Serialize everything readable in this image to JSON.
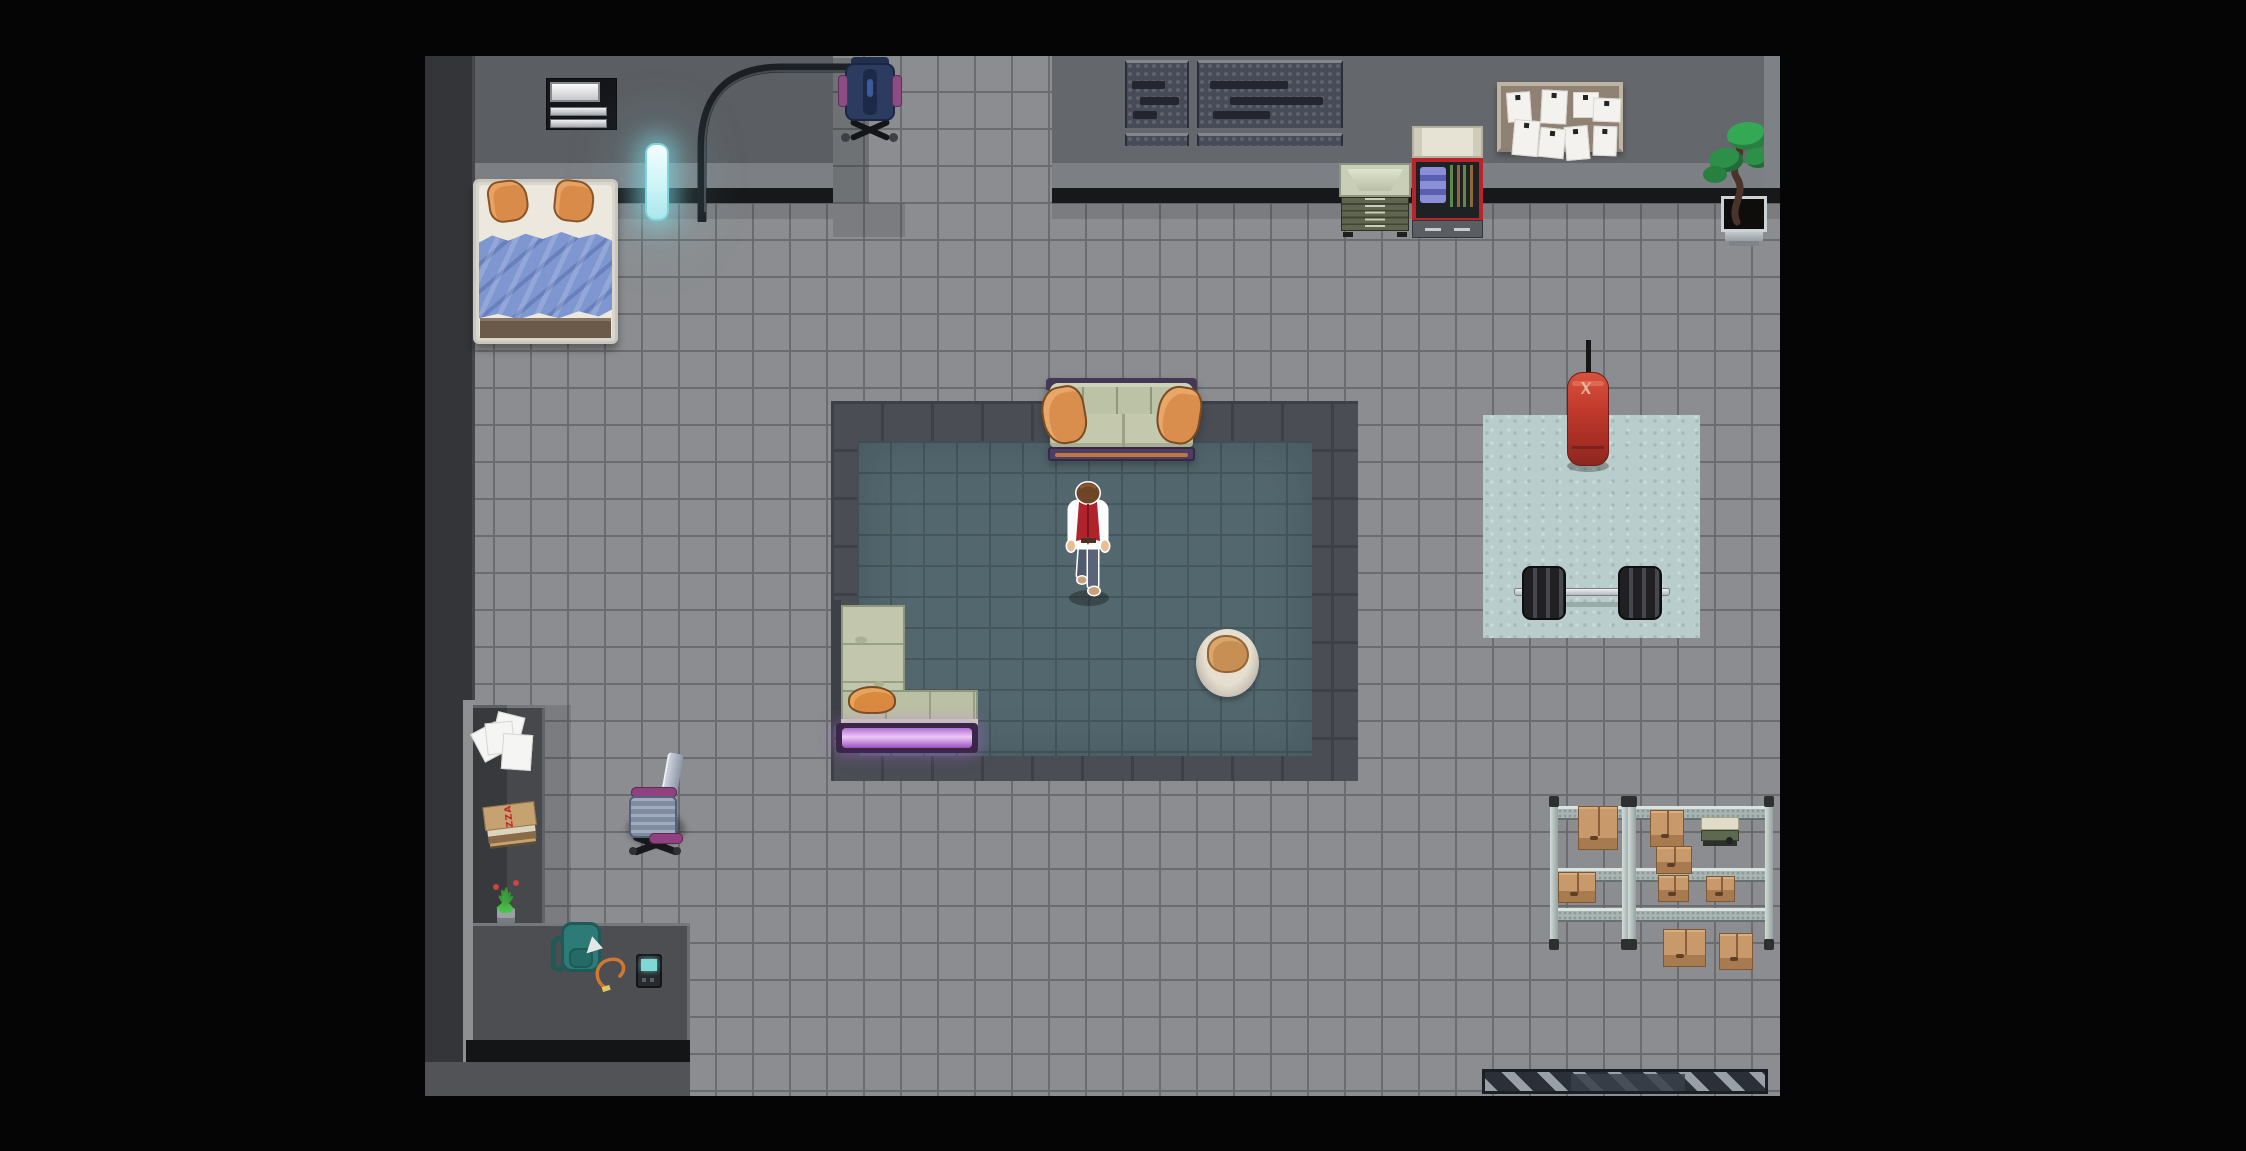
{
  "meta": {
    "scene": "top-down pixel-art apartment / loft interior",
    "viewport": {
      "width": 2246,
      "height": 1151
    },
    "map": {
      "x": 425,
      "y": 56,
      "width": 1355,
      "height": 1040
    }
  },
  "labels": {
    "pizza_box_text": "PIZZA"
  },
  "palette": {
    "letterbox": "#050505",
    "floor_tile": "#8b8d90",
    "floor_grout": "#6a6c6f",
    "wall_left": "#5b5e62",
    "wall_right": "#64676b",
    "wall_band": "#7c7f84",
    "wall_base": "#17181a",
    "border_zone": "#4a4d54",
    "rug_teal": "#53676e",
    "gym_mat": "#b9cecc",
    "dark_zone": "#46484c",
    "hazard_light": "#99a0a8",
    "hazard_dark": "#2a2f38",
    "sofa_green": "#c2c6ad",
    "pillow_orange": "#d98c4a",
    "sofa_base_purple": "#4e3e65",
    "glow_purple": "#ecc9f7",
    "bed_blanket_blue": "#7e97d0",
    "punching_bag_red": "#c23a2c",
    "tube_cyan": "#cdf4f6",
    "box_cardboard": "#c89a6b",
    "rack_metal": "#a9b5b2",
    "player_vest": "#b0222c",
    "player_shirt": "#fcfcfc",
    "player_pants": "#59647a",
    "player_hair": "#6f4527"
  },
  "entities": [
    {
      "name": "letterbox-left",
      "type": "letterbox",
      "x": 0,
      "y": 0,
      "w": 425,
      "h": 1151
    },
    {
      "name": "letterbox-right",
      "type": "letterbox",
      "x": 1780,
      "y": 0,
      "w": 466,
      "h": 1151
    },
    {
      "name": "letterbox-top",
      "type": "letterbox",
      "x": 425,
      "y": 0,
      "w": 1355,
      "h": 56
    },
    {
      "name": "letterbox-bottom",
      "type": "letterbox",
      "x": 425,
      "y": 1096,
      "w": 1355,
      "h": 55
    },
    {
      "name": "floor-tiles",
      "type": "floor",
      "x": 425,
      "y": 56,
      "w": 1355,
      "h": 1040
    },
    {
      "name": "left-wall-column",
      "type": "leftcol",
      "x": 425,
      "y": 56,
      "w": 50,
      "h": 1040
    },
    {
      "name": "left-edge-strip",
      "type": "lightstrip",
      "x": 463,
      "y": 700,
      "w": 12,
      "h": 362
    },
    {
      "name": "top-wall-left",
      "type": "wallL",
      "x": 475,
      "y": 56,
      "w": 358,
      "h": 147
    },
    {
      "name": "top-wall-right",
      "type": "wallR",
      "x": 1052,
      "y": 56,
      "w": 728,
      "h": 147
    },
    {
      "name": "right-wall-strip",
      "type": "wallstrip",
      "x": 1764,
      "y": 56,
      "w": 16,
      "h": 132
    },
    {
      "name": "corridor-shadow",
      "type": "shade22",
      "x": 833,
      "y": 58,
      "w": 36,
      "h": 145
    },
    {
      "name": "corridor-shadow-foot",
      "type": "shade12",
      "x": 833,
      "y": 203,
      "w": 72,
      "h": 34
    },
    {
      "name": "wall-shadow-left",
      "type": "shade12",
      "x": 475,
      "y": 203,
      "w": 358,
      "h": 16
    },
    {
      "name": "wall-shadow-right",
      "type": "shade12",
      "x": 1052,
      "y": 203,
      "w": 728,
      "h": 16
    },
    {
      "name": "sunken-border-zone",
      "type": "borderzone",
      "x": 831,
      "y": 401,
      "w": 527,
      "h": 380
    },
    {
      "name": "teal-rug",
      "type": "rug",
      "x": 857,
      "y": 441,
      "w": 455,
      "h": 315
    },
    {
      "name": "gym-mat",
      "type": "mat",
      "x": 1483,
      "y": 415,
      "w": 217,
      "h": 223
    },
    {
      "name": "storage-nook-column",
      "type": "darkzone",
      "x": 473,
      "y": 705,
      "w": 72,
      "h": 218
    },
    {
      "name": "storage-nook-platform",
      "type": "darkzone2",
      "x": 473,
      "y": 923,
      "w": 217,
      "h": 118
    },
    {
      "name": "storage-nook-shadow",
      "type": "shade12",
      "x": 545,
      "y": 705,
      "w": 26,
      "h": 218
    },
    {
      "name": "dark-desk-strip",
      "type": "darkdesk",
      "x": 466,
      "y": 1040,
      "w": 224,
      "h": 24
    },
    {
      "name": "bottom-wall-strip",
      "type": "bottomwall",
      "x": 425,
      "y": 1062,
      "w": 265,
      "h": 34
    },
    {
      "name": "hazard-strip",
      "type": "hazard",
      "x": 1482,
      "y": 1069,
      "w": 286,
      "h": 25
    },
    {
      "name": "hazard-strip-inset",
      "type": "hazardinner",
      "x": 1571,
      "y": 1074,
      "w": 114,
      "h": 17
    },
    {
      "name": "wall-shelf-unit",
      "type": "shelfunit",
      "x": 546,
      "y": 78,
      "w": 71,
      "h": 52
    },
    {
      "name": "floor-lamp",
      "type": "lamp",
      "x": 676,
      "y": 52,
      "w": 216,
      "h": 170
    },
    {
      "name": "neon-light-tube",
      "type": "tube",
      "x": 645,
      "y": 143,
      "w": 24,
      "h": 78
    },
    {
      "name": "gaming-chair",
      "type": "gamingchair",
      "x": 841,
      "y": 57,
      "w": 58,
      "h": 86
    },
    {
      "name": "acoustic-panel-left",
      "type": "acoustic",
      "x": 1125,
      "y": 60,
      "w": 64,
      "h": 68
    },
    {
      "name": "acoustic-panel-right",
      "type": "acoustic",
      "x": 1197,
      "y": 60,
      "w": 146,
      "h": 68
    },
    {
      "name": "acoustic-panel-left-lower",
      "type": "acoustic2",
      "x": 1125,
      "y": 133,
      "w": 64,
      "h": 13
    },
    {
      "name": "acoustic-panel-right-lower",
      "type": "acoustic2",
      "x": 1197,
      "y": 133,
      "w": 146,
      "h": 13
    },
    {
      "name": "green-file-cabinet",
      "type": "greencab",
      "x": 1339,
      "y": 163,
      "w": 72,
      "h": 74
    },
    {
      "name": "red-workbench-cabinet",
      "type": "workbench",
      "x": 1412,
      "y": 126,
      "w": 71,
      "h": 112
    },
    {
      "name": "bulletin-board",
      "type": "bulletin",
      "x": 1497,
      "y": 82,
      "w": 126,
      "h": 70
    },
    {
      "name": "bonsai-plant",
      "type": "bonsai",
      "x": 1703,
      "y": 122,
      "w": 70,
      "h": 124
    },
    {
      "name": "bed",
      "type": "bed",
      "x": 473,
      "y": 179,
      "w": 145,
      "h": 165
    },
    {
      "name": "sofa",
      "type": "sofaTop",
      "x": 1046,
      "y": 378,
      "w": 151,
      "h": 83
    },
    {
      "name": "corner-sofa",
      "type": "cornerSofa",
      "x": 834,
      "y": 600,
      "w": 148,
      "h": 155
    },
    {
      "name": "ottoman-pouf",
      "type": "pouf",
      "x": 1196,
      "y": 629,
      "w": 63,
      "h": 68
    },
    {
      "name": "punching-bag",
      "type": "punchbag",
      "x": 1564,
      "y": 340,
      "w": 48,
      "h": 132
    },
    {
      "name": "barbell",
      "type": "barbell",
      "x": 1514,
      "y": 566,
      "w": 156,
      "h": 56
    },
    {
      "name": "storage-rack-left",
      "type": "rack",
      "x": 1550,
      "y": 798,
      "w": 80,
      "h": 150
    },
    {
      "name": "storage-rack-right",
      "type": "rack",
      "x": 1628,
      "y": 798,
      "w": 145,
      "h": 150
    },
    {
      "name": "box-rack-left-top",
      "type": "box",
      "x": 1578,
      "y": 806,
      "w": 40,
      "h": 44
    },
    {
      "name": "box-rack-left-mid",
      "type": "box",
      "x": 1558,
      "y": 872,
      "w": 38,
      "h": 31
    },
    {
      "name": "box-rack-right-top",
      "type": "box",
      "x": 1650,
      "y": 810,
      "w": 34,
      "h": 37
    },
    {
      "name": "box-rack-right-hang",
      "type": "box",
      "x": 1656,
      "y": 846,
      "w": 36,
      "h": 28
    },
    {
      "name": "box-rack-right-mid1",
      "type": "box",
      "x": 1658,
      "y": 875,
      "w": 31,
      "h": 27
    },
    {
      "name": "box-rack-right-mid2",
      "type": "box",
      "x": 1706,
      "y": 876,
      "w": 29,
      "h": 26
    },
    {
      "name": "toolbox",
      "type": "toolbox",
      "x": 1701,
      "y": 817,
      "w": 38,
      "h": 29
    },
    {
      "name": "box-floor-1",
      "type": "box",
      "x": 1663,
      "y": 929,
      "w": 43,
      "h": 38
    },
    {
      "name": "box-floor-2",
      "type": "box",
      "x": 1719,
      "y": 933,
      "w": 34,
      "h": 37
    },
    {
      "name": "office-chair",
      "type": "officechair",
      "x": 627,
      "y": 753,
      "w": 58,
      "h": 103
    },
    {
      "name": "scattered-papers",
      "type": "papers",
      "x": 476,
      "y": 714,
      "w": 58,
      "h": 60
    },
    {
      "name": "pizza-box",
      "type": "pizzabox",
      "x": 485,
      "y": 804,
      "w": 52,
      "h": 46
    },
    {
      "name": "potted-plant-small",
      "type": "smallplant",
      "x": 489,
      "y": 878,
      "w": 34,
      "h": 45
    },
    {
      "name": "backpack",
      "type": "backpack",
      "x": 551,
      "y": 920,
      "w": 54,
      "h": 56
    },
    {
      "name": "charging-device",
      "type": "device",
      "x": 592,
      "y": 950,
      "w": 76,
      "h": 44
    },
    {
      "name": "player-character",
      "type": "player",
      "x": 1056,
      "y": 481,
      "w": 64,
      "h": 130,
      "interactable": true
    }
  ]
}
